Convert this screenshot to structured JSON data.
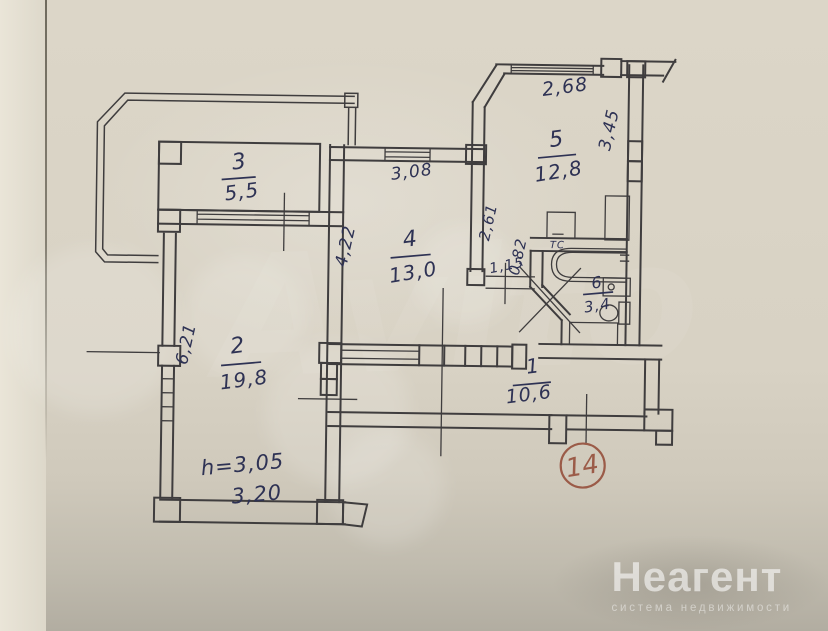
{
  "plan": {
    "apartment_badge": "14",
    "rooms": {
      "r1": {
        "number": "1",
        "area": "10,6"
      },
      "r2": {
        "number": "2",
        "area": "19,8"
      },
      "r3": {
        "number": "3",
        "area": "5,5"
      },
      "r4": {
        "number": "4",
        "area": "13,0"
      },
      "r5": {
        "number": "5",
        "area": "12,8"
      },
      "r6": {
        "number": "6",
        "area": "3,4"
      }
    },
    "dimensions": {
      "room5_top": "2,68",
      "room5_right": "3,45",
      "room4_top": "3,08",
      "room4_left": "4,22",
      "corridor_depth": "2,61",
      "corridor_width": "0,82",
      "corridor_door": "1,15",
      "room2_left": "6,21",
      "ceiling_height": "h=3,05",
      "room2_bottom": "3,20"
    },
    "fixtures": {
      "heated_rail_label": "ТС"
    }
  },
  "watermark": {
    "brand": "Avito"
  },
  "branding": {
    "logo": "Неагент",
    "tagline": "система недвижимости"
  },
  "colors": {
    "paper": "#d8d2c4",
    "ink": "#3f3d3e",
    "hand_ink": "#2e3254",
    "badge_ink": "#9b5b48",
    "fixture_blue": "#3c3cae"
  }
}
